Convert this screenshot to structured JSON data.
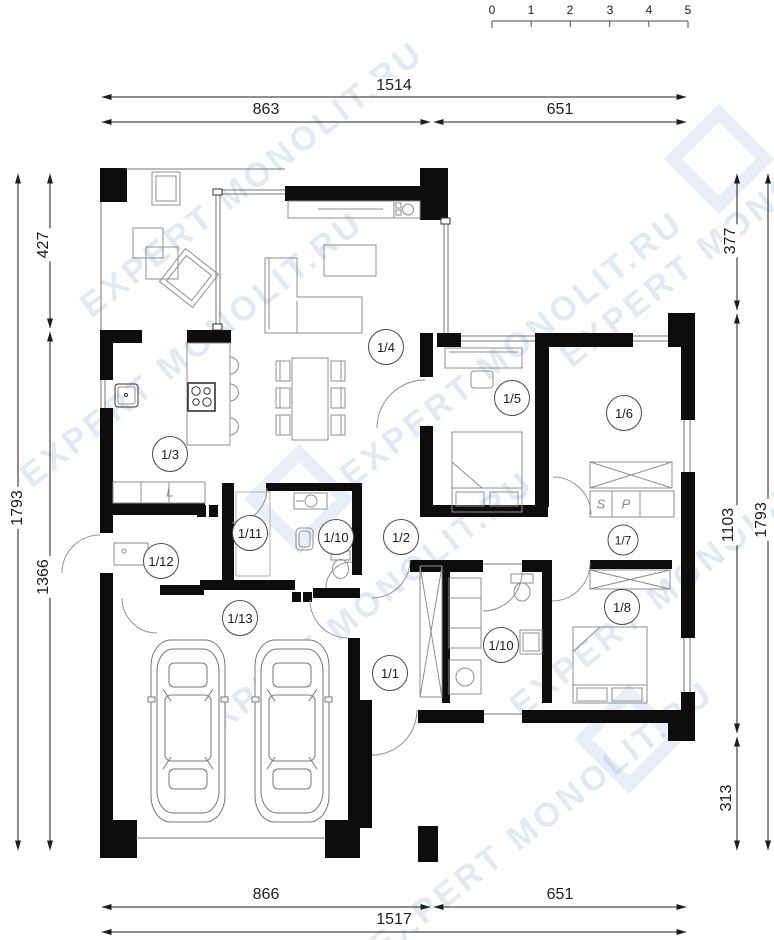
{
  "watermark": {
    "text": "EXPERT MONOLIT.RU"
  },
  "scale_bar": {
    "ticks": [
      "0",
      "1",
      "2",
      "3",
      "4",
      "5"
    ]
  },
  "dimensions": {
    "top": {
      "total": "1514",
      "left": "863",
      "right": "651"
    },
    "bottom": {
      "left": "866",
      "right": "651",
      "total": "1517"
    },
    "left": {
      "outer": "1793",
      "upper": "427",
      "lower": "1366"
    },
    "right": {
      "upper": "377",
      "middle": "1103",
      "lower": "313",
      "outer": "1793"
    }
  },
  "rooms": [
    {
      "label": "1/1"
    },
    {
      "label": "1/2"
    },
    {
      "label": "1/3"
    },
    {
      "label": "1/4"
    },
    {
      "label": "1/5"
    },
    {
      "label": "1/6"
    },
    {
      "label": "1/7"
    },
    {
      "label": "1/8"
    },
    {
      "label": "1/10"
    },
    {
      "label": "1/10"
    },
    {
      "label": "1/11"
    },
    {
      "label": "1/12"
    },
    {
      "label": "1/13"
    }
  ],
  "cabinet_letters": {
    "s": "S",
    "p": "P",
    "l": "L"
  }
}
